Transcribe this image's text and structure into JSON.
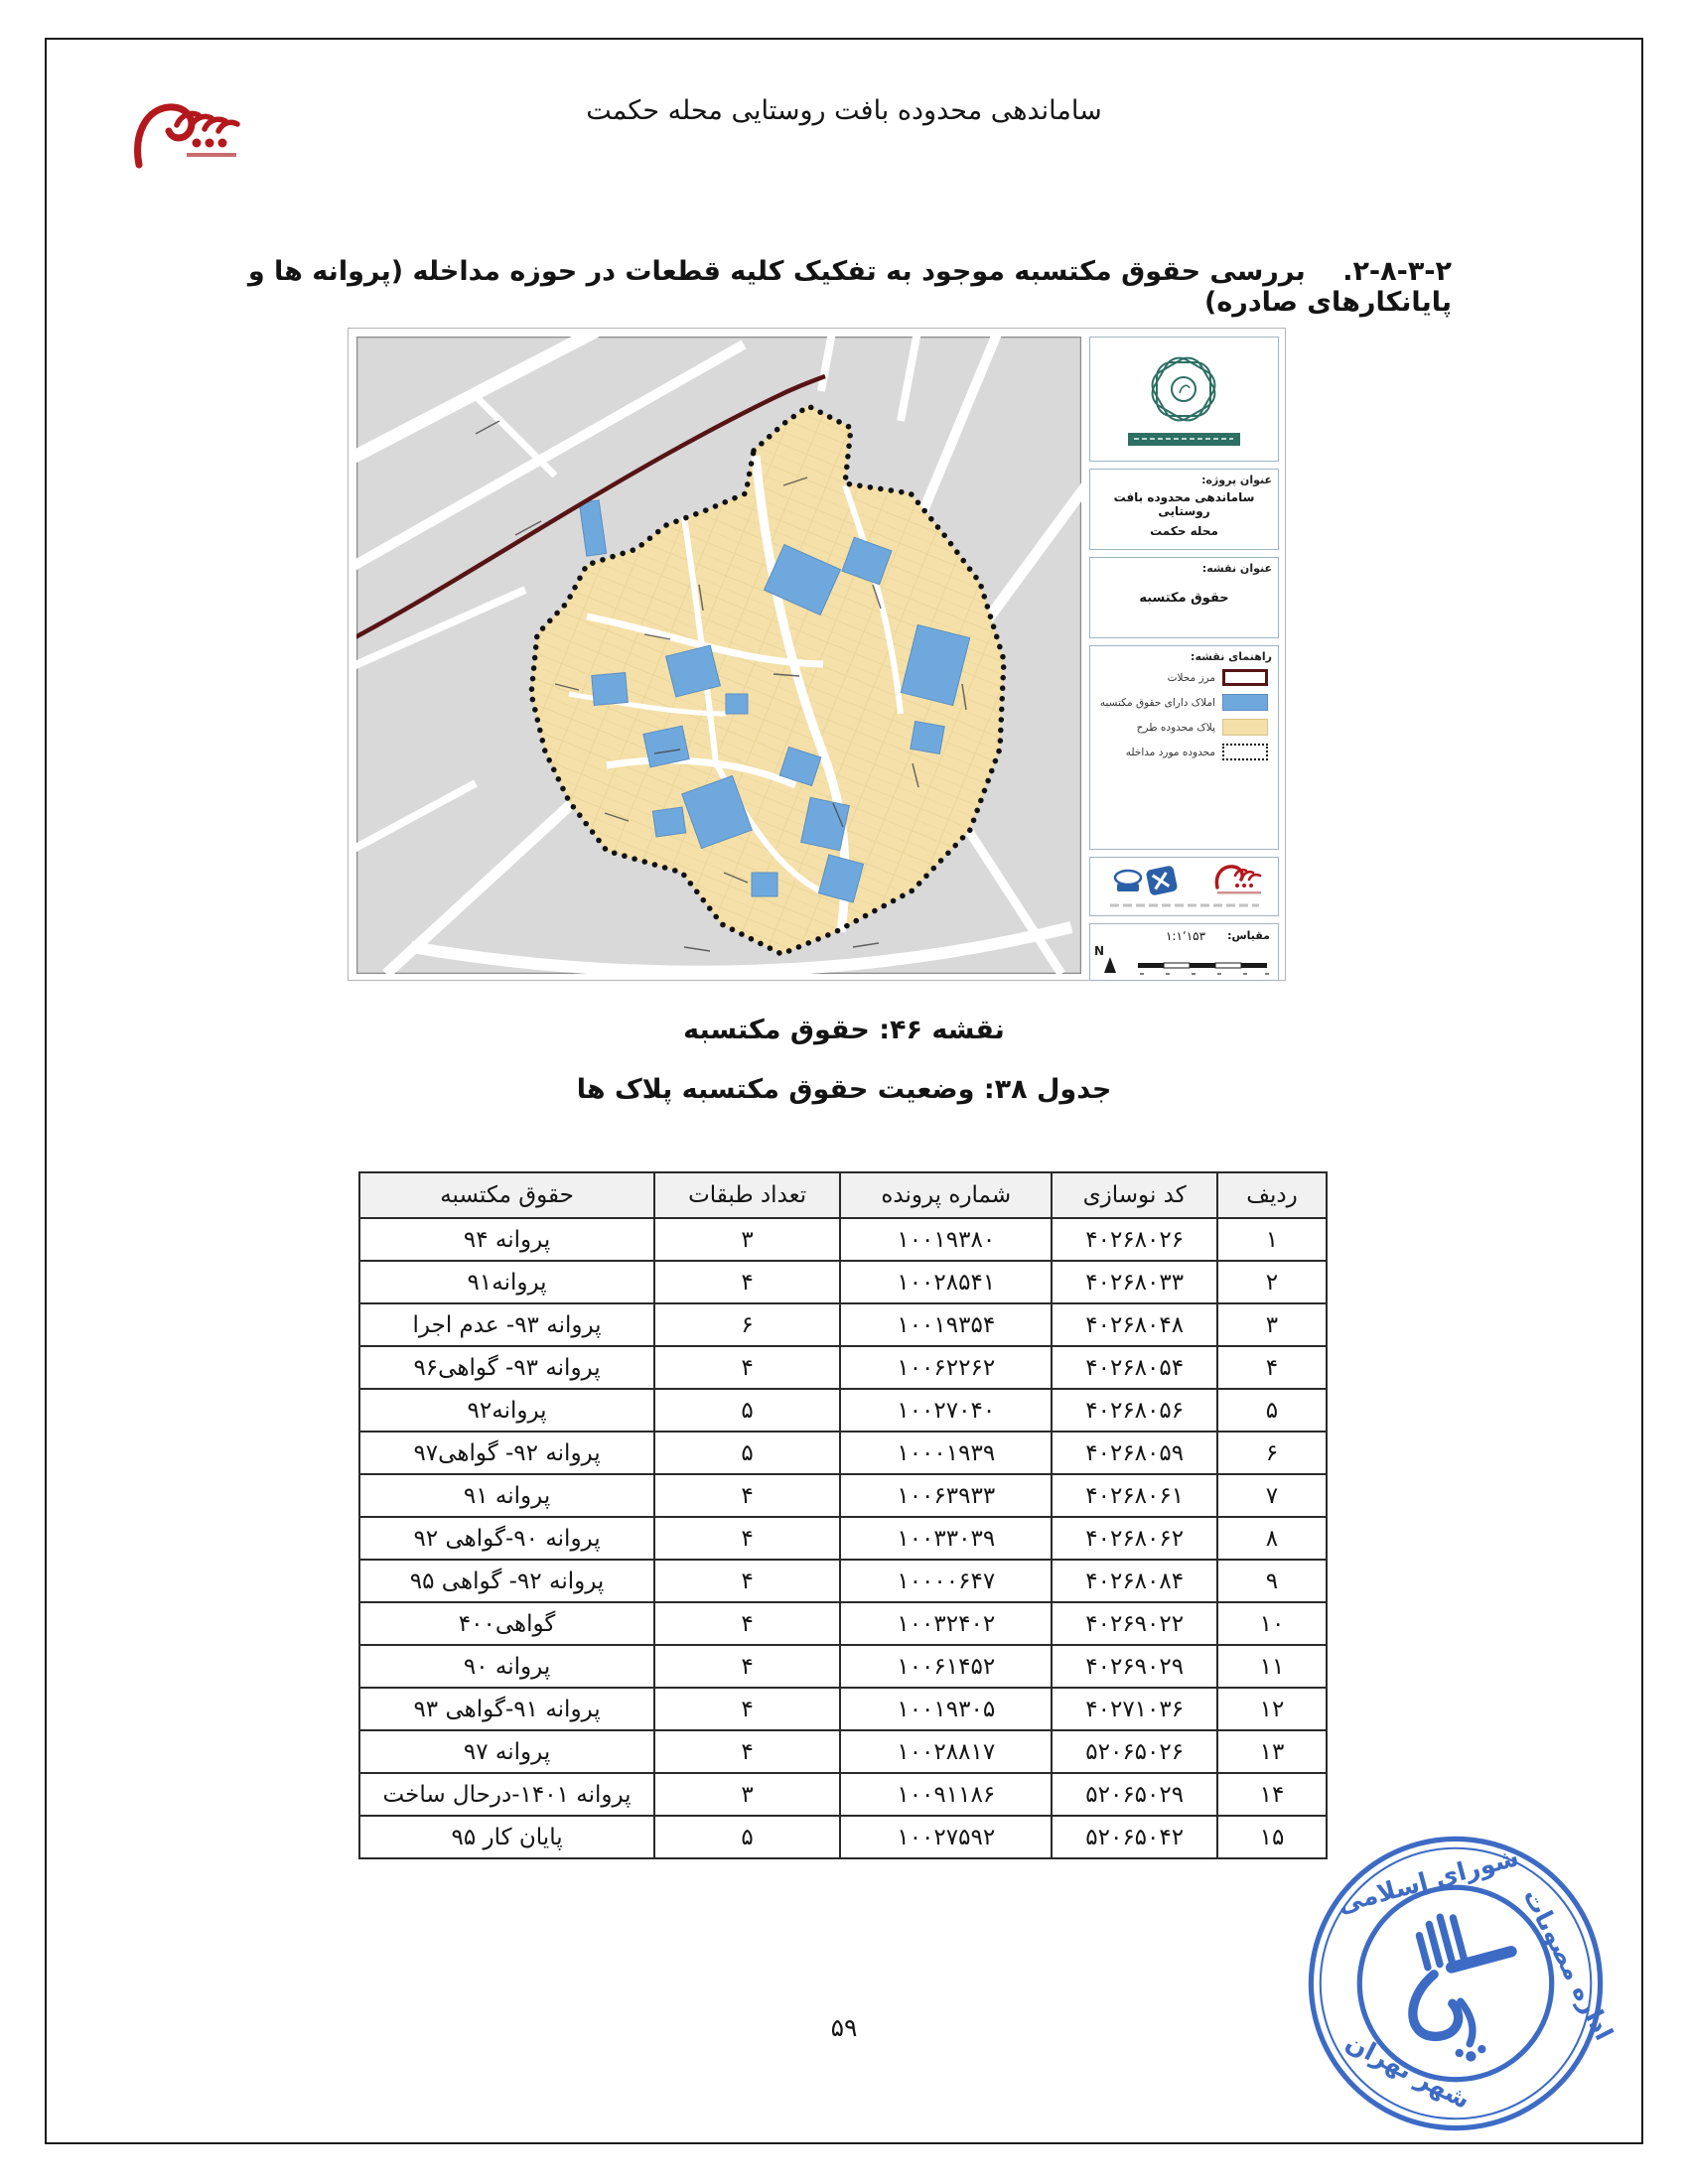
{
  "page": {
    "header_title": "ساماندهی محدوده بافت روستایی محله حکمت",
    "page_number": "۵۹"
  },
  "section": {
    "number": "۲-۸-۳-۲.",
    "title": "بررسی حقوق مکتسبه موجود به تفکیک کلیه قطعات در حوزه مداخله (پروانه ها و پایانکارهای صادره)",
    "body": "در محدوده مورد مطالعه ۱۵ پلاک دارای حقوق مکتسبه بعد از سال ۹۰ هستند."
  },
  "figure": {
    "panel": {
      "project_label": "عنوان پروژه:",
      "project_title_line1": "ساماندهی محدوده بافت روستایی",
      "project_title_line2": "محله حکمت",
      "map_title_label": "عنوان نقشه:",
      "map_title": "حقوق مکتسبه",
      "legend_label": "راهنمای نقشه:",
      "legend_items": [
        {
          "label": "مرز محلات",
          "swatch": "outline-darkred"
        },
        {
          "label": "املاک دارای حقوق مکتسبه",
          "swatch": "fill-blue"
        },
        {
          "label": "پلاک محدوده طرح",
          "swatch": "fill-beige"
        },
        {
          "label": "محدوده مورد مداخله",
          "swatch": "dashed-black"
        }
      ],
      "scale_label": "مقیاس:",
      "scale_value": "۱:۱٬۱۵۳",
      "north_label": "N"
    },
    "colors": {
      "map_bg": "#d9d9d9",
      "parcel_beige": "#f4e0a8",
      "acquired_blue": "#6fa8dc",
      "district_boundary_red": "#571414",
      "intervention_boundary": "#111111"
    }
  },
  "captions": {
    "map": "نقشه ۴۶:  حقوق مکتسبه",
    "table": "جدول ۳۸: وضعیت حقوق مکتسبه پلاک ها"
  },
  "table": {
    "headers": [
      "ردیف",
      "کد نوسازی",
      "شماره پرونده",
      "تعداد طبقات",
      "حقوق مکتسبه"
    ],
    "rows": [
      [
        "۱",
        "۴۰۲۶۸۰۲۶",
        "۱۰۰۱۹۳۸۰",
        "۳",
        "پروانه ۹۴"
      ],
      [
        "۲",
        "۴۰۲۶۸۰۳۳",
        "۱۰۰۲۸۵۴۱",
        "۴",
        "پروانه۹۱"
      ],
      [
        "۳",
        "۴۰۲۶۸۰۴۸",
        "۱۰۰۱۹۳۵۴",
        "۶",
        "پروانه ۹۳- عدم اجرا"
      ],
      [
        "۴",
        "۴۰۲۶۸۰۵۴",
        "۱۰۰۶۲۲۶۲",
        "۴",
        "پروانه ۹۳- گواهی۹۶"
      ],
      [
        "۵",
        "۴۰۲۶۸۰۵۶",
        "۱۰۰۲۷۰۴۰",
        "۵",
        "پروانه۹۲"
      ],
      [
        "۶",
        "۴۰۲۶۸۰۵۹",
        "۱۰۰۰۱۹۳۹",
        "۵",
        "پروانه ۹۲- گواهی۹۷"
      ],
      [
        "۷",
        "۴۰۲۶۸۰۶۱",
        "۱۰۰۶۳۹۳۳",
        "۴",
        "پروانه ۹۱"
      ],
      [
        "۸",
        "۴۰۲۶۸۰۶۲",
        "۱۰۰۳۳۰۳۹",
        "۴",
        "پروانه ۹۰-گواهی ۹۲"
      ],
      [
        "۹",
        "۴۰۲۶۸۰۸۴",
        "۱۰۰۰۰۶۴۷",
        "۴",
        "پروانه ۹۲- گواهی ۹۵"
      ],
      [
        "۱۰",
        "۴۰۲۶۹۰۲۲",
        "۱۰۰۳۲۴۰۲",
        "۴",
        "گواهی۴۰۰"
      ],
      [
        "۱۱",
        "۴۰۲۶۹۰۲۹",
        "۱۰۰۶۱۴۵۲",
        "۴",
        "پروانه ۹۰"
      ],
      [
        "۱۲",
        "۴۰۲۷۱۰۳۶",
        "۱۰۰۱۹۳۰۵",
        "۴",
        "پروانه ۹۱-گواهی ۹۳"
      ],
      [
        "۱۳",
        "۵۲۰۶۵۰۲۶",
        "۱۰۰۲۸۸۱۷",
        "۴",
        "پروانه ۹۷"
      ],
      [
        "۱۴",
        "۵۲۰۶۵۰۲۹",
        "۱۰۰۹۱۱۸۶",
        "۳",
        "پروانه ۱۴۰۱-درحال ساخت"
      ],
      [
        "۱۵",
        "۵۲۰۶۵۰۴۲",
        "۱۰۰۲۷۵۹۲",
        "۵",
        "پایان کار ۹۵"
      ]
    ]
  },
  "stamp": {
    "text_top": "شورای اسلامی",
    "text_side": "اداره مصوبات",
    "text_bottom": "شهر تهران",
    "color": "#2d5fc0"
  }
}
